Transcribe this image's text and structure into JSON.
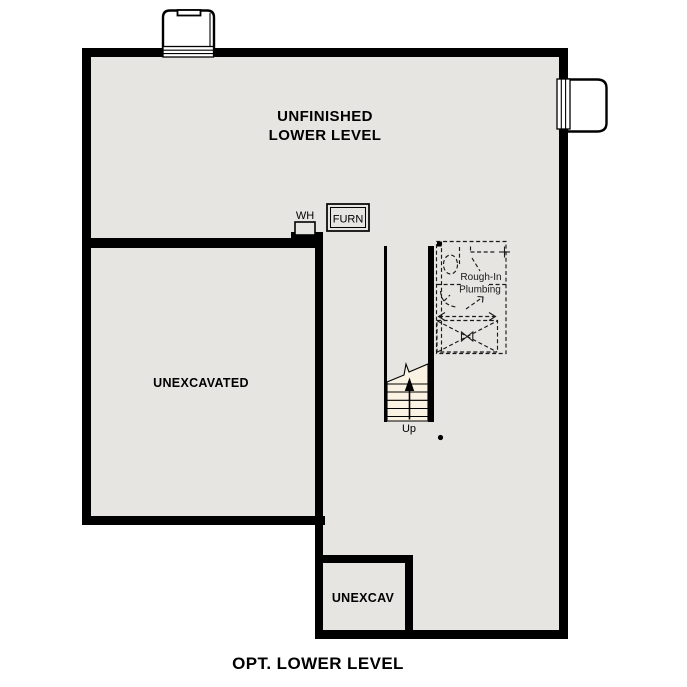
{
  "plan": {
    "caption": "OPT. LOWER LEVEL",
    "rooms": {
      "main": {
        "label_line1": "UNFINISHED",
        "label_line2": "LOWER LEVEL"
      },
      "unexcavated": {
        "label": "UNEXCAVATED"
      },
      "unexcav_small": {
        "label": "UNEXCAV"
      }
    },
    "fixtures": {
      "water_heater": {
        "label": "WH"
      },
      "furnace": {
        "label": "FURN"
      },
      "rough_in_plumbing": {
        "label_line1": "Rough-In",
        "label_line2": "Plumbing"
      },
      "stairs": {
        "direction_label": "Up"
      }
    }
  },
  "colors": {
    "wall": "#000000",
    "floor": "#e7e5e2",
    "stairs": "#faf3e3",
    "well": "#ffffff",
    "page_bg": "#ffffff",
    "text": "#000000"
  }
}
